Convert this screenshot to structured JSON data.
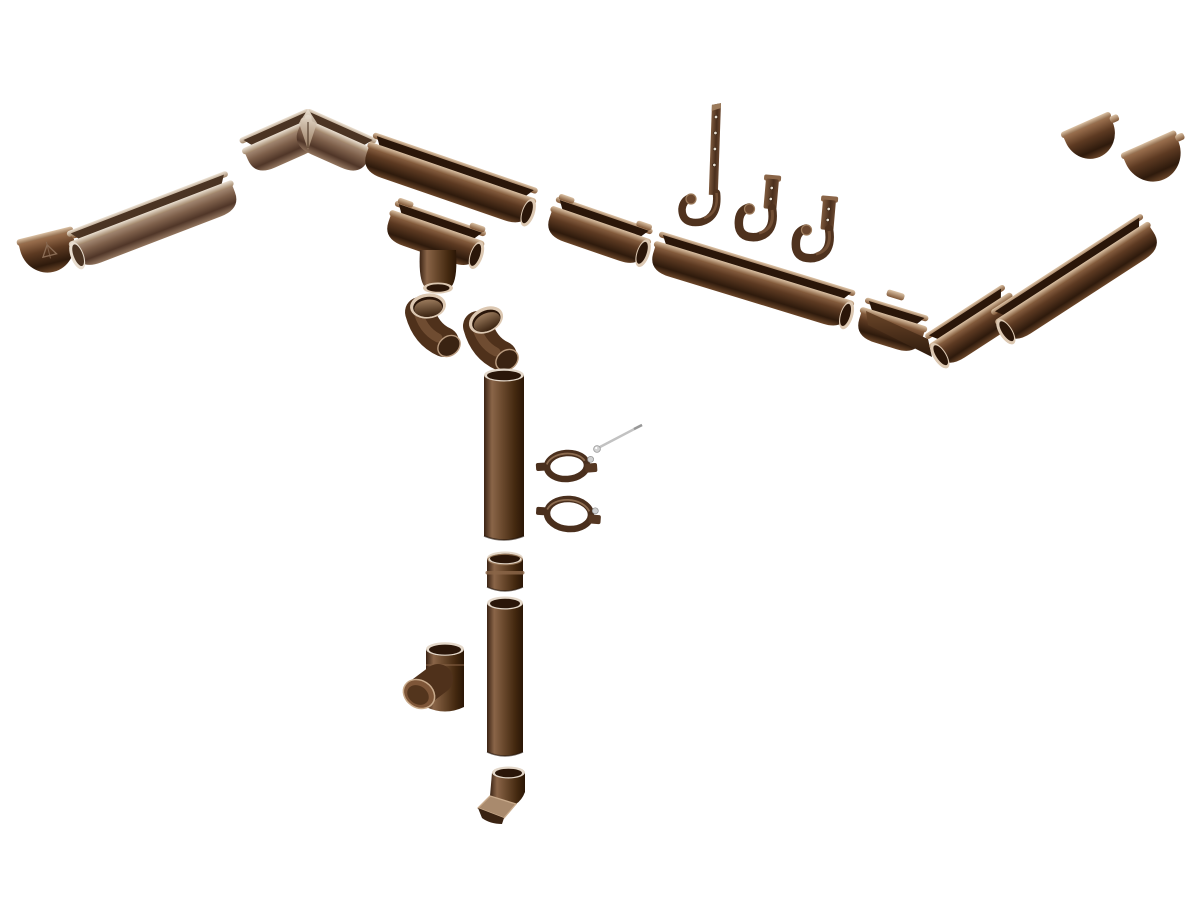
{
  "page": {
    "background": "#ffffff",
    "description": "Exploded product diagram of a chocolate-brown PVC rain gutter and downpipe system on a white background"
  },
  "palette": {
    "chocolate_darkest": "#2a1609",
    "chocolate_dark": "#3a2312",
    "chocolate_mid": "#5d3a22",
    "chocolate_light": "#8a6548",
    "taupe_light": "#b49a85",
    "rim_highlight": "#dcc8b2",
    "screw_metal": "#c6c6c6",
    "background": "#ffffff"
  },
  "diagram": {
    "parts": [
      {
        "id": "endcap-left",
        "label": "Gutter end cap left with embossed brand mark",
        "type": "cap",
        "x": 16,
        "y": 240,
        "rotate": -14,
        "w": 58,
        "variant": "dark",
        "logo": true
      },
      {
        "id": "gutter-left-run",
        "label": "Gutter section left run",
        "type": "gutter",
        "x": 66,
        "y": 232,
        "rotate": -21,
        "len": 172,
        "end": "left",
        "variant": "light"
      },
      {
        "id": "corner-inner-90",
        "label": "Gutter internal corner 90 degrees",
        "type": "cornerIn",
        "x": 308,
        "y": 108,
        "arm": 76,
        "spread": 24,
        "variant": "light"
      },
      {
        "id": "gutter-valley",
        "label": "Gutter section",
        "type": "gutter",
        "x": 374,
        "y": 132,
        "rotate": 19,
        "len": 174,
        "end": "right",
        "variant": "dark"
      },
      {
        "id": "gutter-outlet",
        "label": "Gutter running outlet funnel",
        "type": "outlet",
        "x": 396,
        "y": 200,
        "len": 96
      },
      {
        "id": "gutter-joiner",
        "label": "Gutter union joiner",
        "type": "gutter",
        "x": 557,
        "y": 196,
        "rotate": 19,
        "len": 102,
        "end": "right",
        "variant": "dark",
        "tabs": true
      },
      {
        "id": "hook-long",
        "label": "Gutter rafter strap hook",
        "type": "hookLong",
        "x": 716,
        "y": 103
      },
      {
        "id": "hook-short-1",
        "label": "Gutter fascia bracket",
        "type": "hookShort",
        "x": 772,
        "y": 179
      },
      {
        "id": "hook-short-2",
        "label": "Gutter fascia bracket",
        "type": "hookShort",
        "x": 829,
        "y": 200
      },
      {
        "id": "gutter-main",
        "label": "Gutter section main run",
        "type": "gutter",
        "x": 660,
        "y": 231,
        "rotate": 17,
        "len": 205,
        "end": "right",
        "variant": "dark"
      },
      {
        "id": "corner-outer-90",
        "label": "Gutter external corner 90 degrees",
        "type": "cornerOut",
        "x": 872,
        "y": 289
      },
      {
        "id": "gutter-right-run",
        "label": "Gutter section right run",
        "type": "gutter",
        "x": 990,
        "y": 311,
        "rotate": -33,
        "len": 180,
        "end": "left",
        "variant": "dark"
      },
      {
        "id": "endcap-right-a",
        "label": "Gutter end cap",
        "type": "cap",
        "x": 1060,
        "y": 133,
        "rotate": -24,
        "w": 54,
        "variant": "dark"
      },
      {
        "id": "endcap-right-b",
        "label": "Gutter end cap",
        "type": "cap",
        "x": 1120,
        "y": 154,
        "rotate": -24,
        "w": 60,
        "variant": "dark"
      },
      {
        "id": "elbow-upper",
        "label": "Downpipe elbow",
        "type": "elbow",
        "x": 428,
        "y": 306,
        "tilt": -6
      },
      {
        "id": "elbow-lower",
        "label": "Downpipe elbow",
        "type": "elbow",
        "x": 486,
        "y": 320,
        "tilt": -26
      },
      {
        "id": "downpipe-upper",
        "label": "Downpipe tube upper",
        "type": "pipe",
        "x": 484,
        "y": 368,
        "w": 40,
        "h": 172
      },
      {
        "id": "clamp-screw",
        "label": "Clamp fixing stud screw",
        "type": "screw",
        "x": 596,
        "y": 449
      },
      {
        "id": "clamp-1",
        "label": "Downpipe clamp with stud",
        "type": "clamp",
        "x": 567,
        "y": 466,
        "rotate": -4,
        "rx": 20,
        "ry": 13
      },
      {
        "id": "clamp-2",
        "label": "Downpipe clamp",
        "type": "clamp",
        "x": 569,
        "y": 514,
        "rotate": 4,
        "rx": 22,
        "ry": 15
      },
      {
        "id": "pipe-coupler",
        "label": "Downpipe coupler sleeve",
        "type": "coupler",
        "x": 487,
        "y": 551,
        "w": 36,
        "h": 40
      },
      {
        "id": "downpipe-lower",
        "label": "Downpipe tube lower",
        "type": "pipe",
        "x": 487,
        "y": 596,
        "w": 36,
        "h": 160
      },
      {
        "id": "tee-branch",
        "label": "Downpipe tee branch",
        "type": "tee",
        "x": 426,
        "y": 641
      },
      {
        "id": "outlet-shoe",
        "label": "Downpipe outlet shoe",
        "type": "shoe",
        "x": 492,
        "y": 766
      }
    ]
  }
}
